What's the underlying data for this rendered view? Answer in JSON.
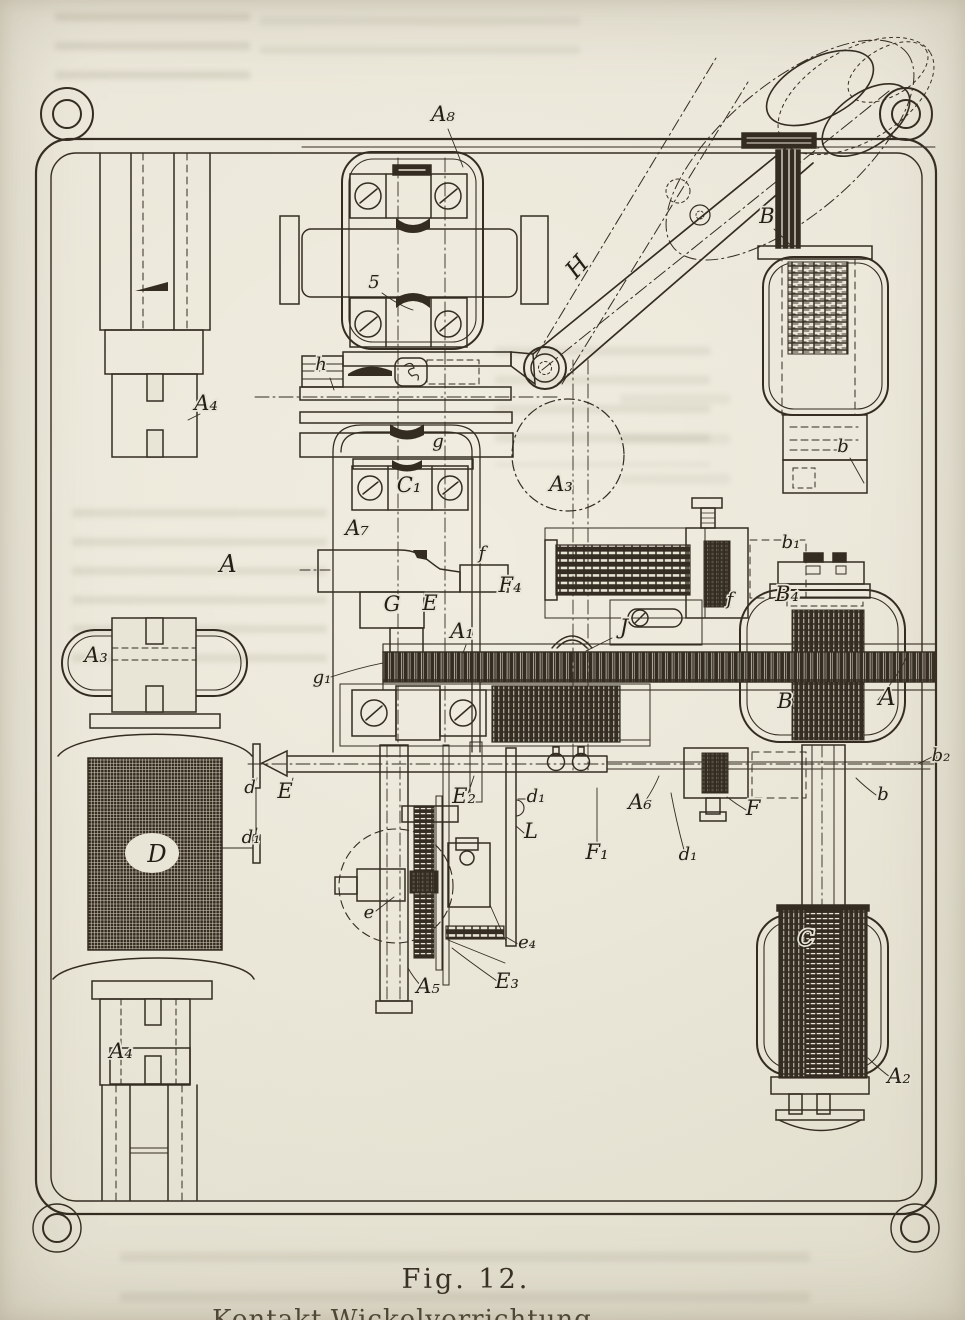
{
  "page": {
    "paper_color": "#e8e4d6",
    "ink_color": "#342c21",
    "caption": {
      "figure_number": "Fig. 12.",
      "caption_line": "Kontakt-Wickelvorrichtung"
    }
  },
  "figure": {
    "description": "Old engraved patent-style plan drawing of a winding mechanism on a rounded base plate: electromagnet coils, gear rack, lead screw, pivoted lever with swing positions, terminal blocks with screws",
    "labels": [
      "A₈",
      "5",
      "h",
      "g",
      "A₄",
      "A",
      "A₃",
      "H",
      "B",
      "b",
      "A₃",
      "C₁",
      "A₇",
      "f",
      "F₄",
      "G",
      "E",
      "A₁",
      "J",
      "g₁",
      "f",
      "B₄",
      "b₁",
      "B",
      "A",
      "b₂",
      "b",
      "E",
      "d",
      "d₁",
      "D",
      "E₂",
      "d₁",
      "L",
      "e",
      "e₄",
      "E₃",
      "A₅",
      "F₁",
      "A₆",
      "F",
      "C",
      "A₂",
      "A₄",
      "d₁"
    ]
  }
}
